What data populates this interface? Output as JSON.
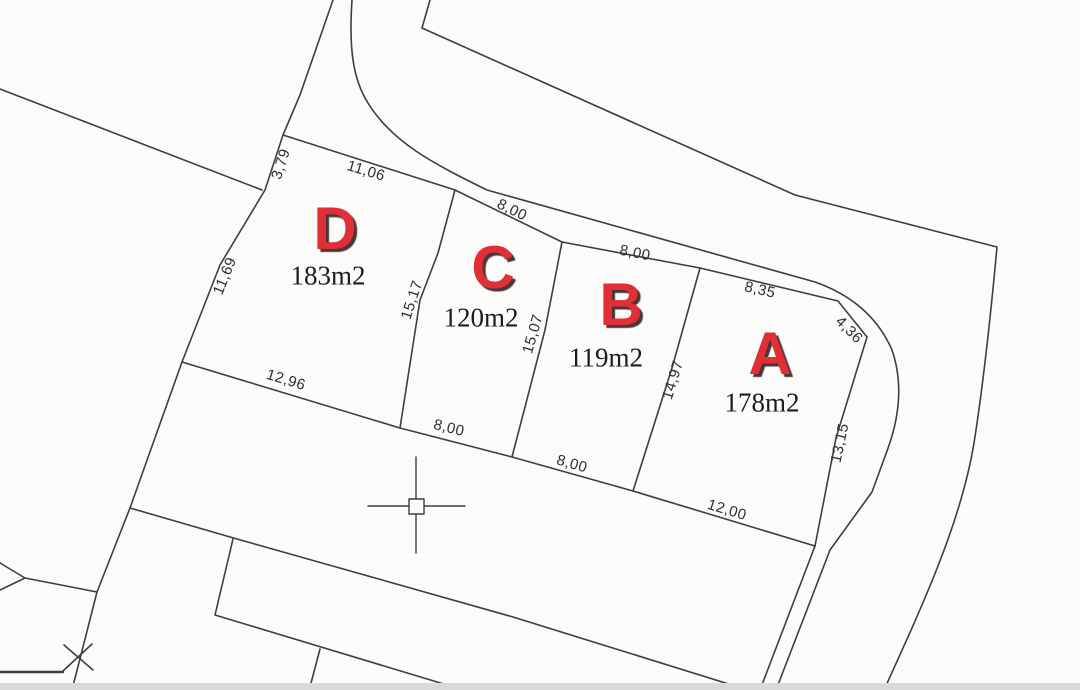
{
  "colors": {
    "paper": "#fbfbfa",
    "ink": "#3e3e3e",
    "parcel_red": "#e02f36",
    "letter_shadow": "#4a3537",
    "bottom_band": "#d9d9d9"
  },
  "parcels": [
    {
      "letter": "A",
      "area": "178m2"
    },
    {
      "letter": "B",
      "area": "119m2"
    },
    {
      "letter": "C",
      "area": "120m2"
    },
    {
      "letter": "D",
      "area": "183m2"
    }
  ],
  "dims": {
    "top_left_short": "3,79",
    "top_d": "11,06",
    "top_c": "8,00",
    "top_b": "8,00",
    "top_a": "8,35",
    "corner_a": "4,36",
    "left_d": "11,69",
    "side_dc": "15,17",
    "side_cb": "15,07",
    "side_ba": "14,97",
    "right_a": "13,15",
    "bottom_d": "12,96",
    "bottom_c": "8,00",
    "bottom_b": "8,00",
    "bottom_a": "12,00"
  }
}
